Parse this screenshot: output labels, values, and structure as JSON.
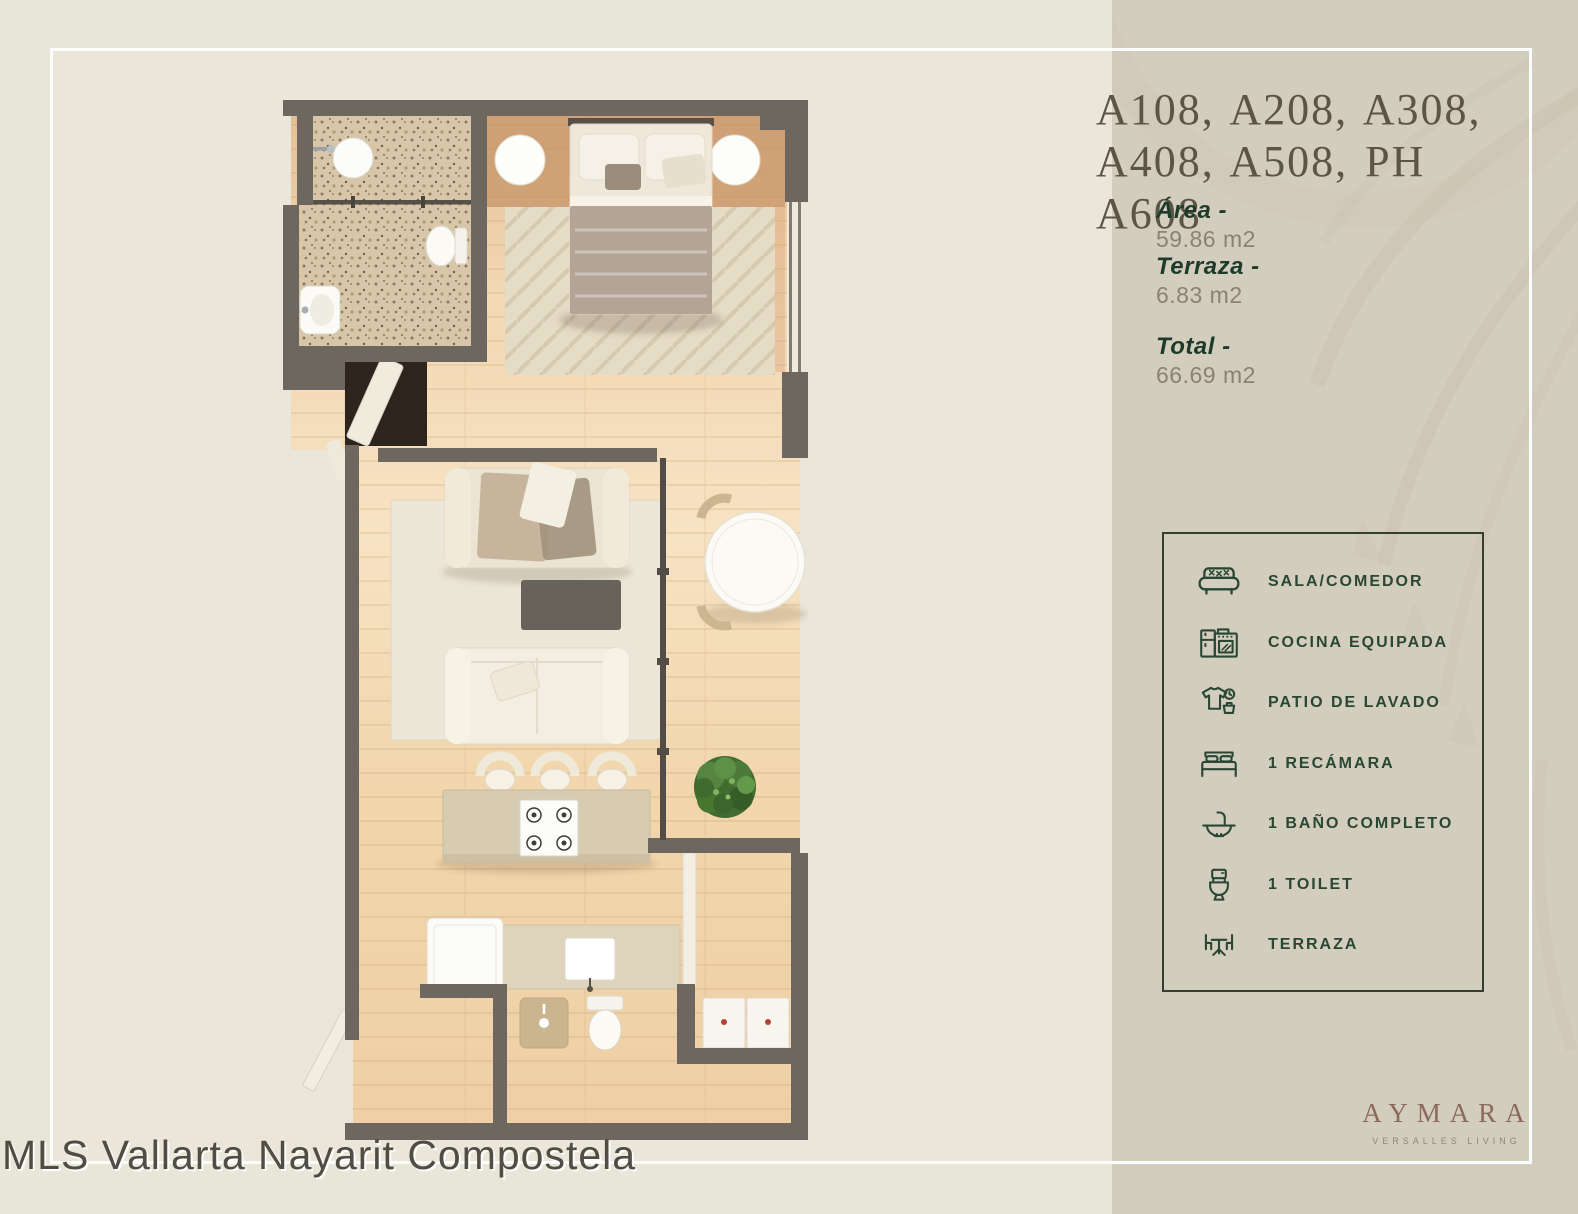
{
  "palette": {
    "page_bg": "#e8e6d8",
    "panel_bg": "#eae7da",
    "sidebar_bg": "#d3cdbe",
    "frame_white": "#ffffff",
    "wall": "#6d675f",
    "wood": "#f3d8b0",
    "terrazzo": "#d8c6a8",
    "accent_green": "#1d3b2a",
    "amenity_green": "#2a4734",
    "value_gray": "#8a8375",
    "title_brown": "#5c5446",
    "brand_brown": "#8c695a"
  },
  "unit": {
    "title_line1": "A108, A208, A308,",
    "title_line2": "A408, A508, PH A608"
  },
  "specs": [
    {
      "label": "Área -",
      "value": "59.86 m2"
    },
    {
      "label": "Terraza -",
      "value": "6.83 m2"
    },
    {
      "label": "Total -",
      "value": "66.69 m2"
    }
  ],
  "amenities": [
    {
      "icon": "sofa-icon",
      "label": "SALA/COMEDOR"
    },
    {
      "icon": "kitchen-icon",
      "label": "COCINA EQUIPADA"
    },
    {
      "icon": "laundry-icon",
      "label": "PATIO DE LAVADO"
    },
    {
      "icon": "bed-icon",
      "label": "1 RECÁMARA"
    },
    {
      "icon": "bathroom-sink-icon",
      "label": "1 BAÑO COMPLETO"
    },
    {
      "icon": "toilet-icon",
      "label": "1 TOILET"
    },
    {
      "icon": "terrace-icon",
      "label": "TERRAZA"
    }
  ],
  "brand": {
    "name": "AYMARA",
    "tagline": "VERSALLES LIVING"
  },
  "watermark": "MLS Vallarta Nayarit Compostela"
}
